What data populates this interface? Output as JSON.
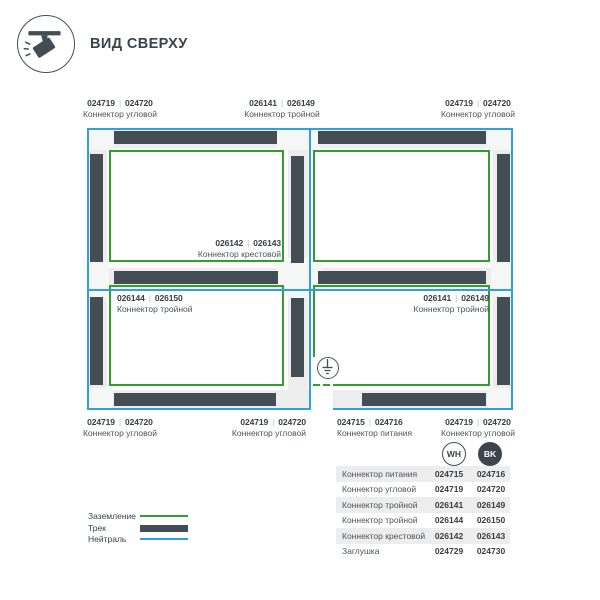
{
  "sep": "|",
  "header": {
    "title": "ВИД СВЕРХУ"
  },
  "colors": {
    "track": "#454d54",
    "ground": "#2da02d",
    "neutral": "#2f9fe0",
    "band": "#ededee",
    "text": "#39434a"
  },
  "diagram": {
    "top_labels": [
      {
        "wh": "024719",
        "bk": "024720",
        "name": "Коннектор угловой"
      },
      {
        "wh": "026141",
        "bk": "026149",
        "name": "Коннектор тройной"
      },
      {
        "wh": "024719",
        "bk": "024720",
        "name": "Коннектор угловой"
      }
    ],
    "inner_labels": [
      {
        "wh": "026142",
        "bk": "026143",
        "name": "Коннектор крестовой"
      },
      {
        "wh": "026144",
        "bk": "026150",
        "name": "Коннектор тройной"
      },
      {
        "wh": "026141",
        "bk": "026149",
        "name": "Коннектор тройной"
      }
    ],
    "bottom_labels": [
      {
        "wh": "024719",
        "bk": "024720",
        "name": "Коннектор угловой"
      },
      {
        "wh": "024719",
        "bk": "024720",
        "name": "Коннектор угловой"
      },
      {
        "wh": "024715",
        "bk": "024716",
        "name": "Коннектор питания"
      },
      {
        "wh": "024719",
        "bk": "024720",
        "name": "Коннектор угловой"
      }
    ]
  },
  "parts_table": {
    "col_wh": "WH",
    "col_bk": "BK",
    "rows": [
      {
        "name": "Коннектор питания",
        "wh": "024715",
        "bk": "024716"
      },
      {
        "name": "Коннектор угловой",
        "wh": "024719",
        "bk": "024720"
      },
      {
        "name": "Коннектор тройной",
        "wh": "026141",
        "bk": "026149"
      },
      {
        "name": "Коннектор тройной",
        "wh": "026144",
        "bk": "026150"
      },
      {
        "name": "Коннектор крестовой",
        "wh": "026142",
        "bk": "026143"
      },
      {
        "name": "Заглушка",
        "wh": "024729",
        "bk": "024730"
      }
    ]
  },
  "legend": {
    "items": [
      {
        "label": "Заземление"
      },
      {
        "label": "Трек"
      },
      {
        "label": "Нейтраль"
      }
    ]
  }
}
